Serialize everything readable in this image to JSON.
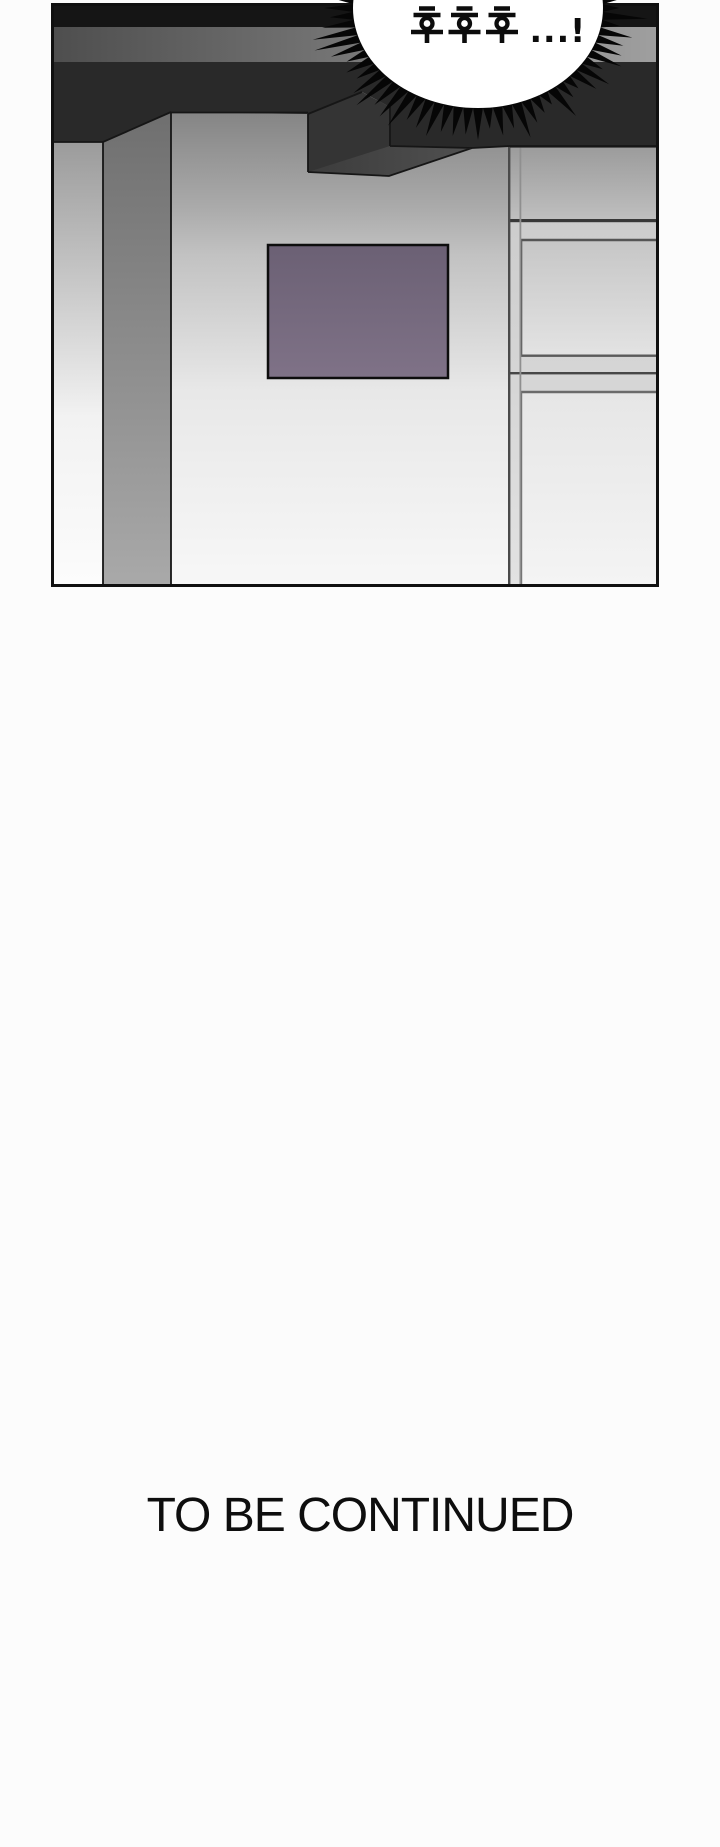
{
  "panel": {
    "bubble": {
      "text": "후후후...!",
      "shape": "spiky-burst",
      "fill": "#ffffff",
      "ink": "#0c0c0c"
    },
    "colors": {
      "ceiling_black": "#151515",
      "ceiling_gray_left": "#4e4e4e",
      "ceiling_gray_right": "#9f9f9f",
      "ceiling_dark_band": "#292929",
      "beam_front": "#343434",
      "beam_underside": "#454545",
      "frame_purple": "#75687c",
      "wall_light": "#f6f6f6",
      "outline_ink": "#101010"
    }
  },
  "footer": {
    "continued_text": "TO BE CONTINUED"
  }
}
